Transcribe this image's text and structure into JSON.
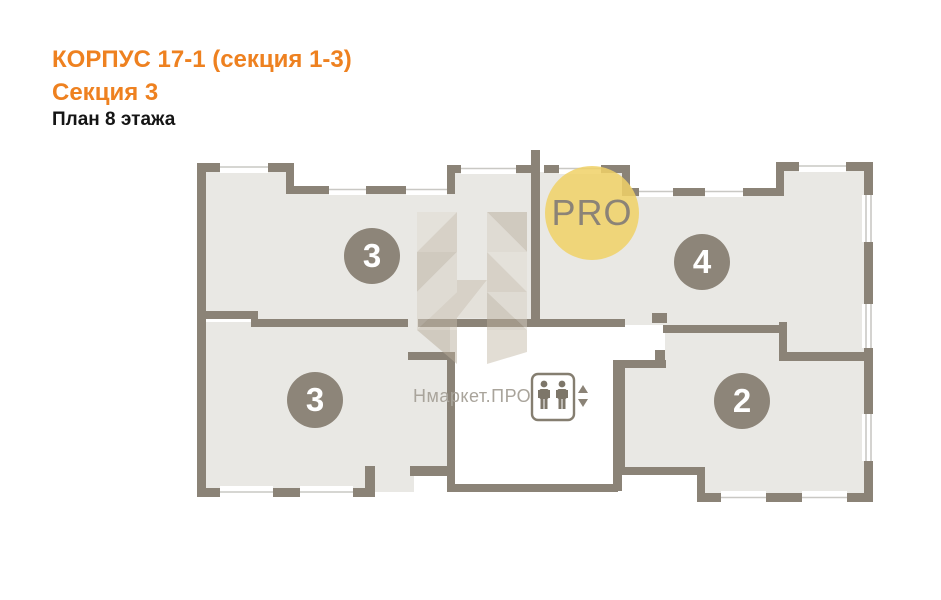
{
  "header": {
    "building_title": "КОРПУС 17-1 (секция 1-3)",
    "section_title": "Секция 3",
    "floor_title": "План 8 этажа"
  },
  "floorplan": {
    "apartments": [
      {
        "position": "top-left",
        "number": "3"
      },
      {
        "position": "top-right",
        "number": "4"
      },
      {
        "position": "bottom-left",
        "number": "3"
      },
      {
        "position": "bottom-right",
        "number": "2"
      }
    ],
    "elevator": {
      "type": "passenger-elevator",
      "figures": 2,
      "arrows": [
        "up",
        "down"
      ]
    }
  },
  "watermark": {
    "logo_text": "PRO",
    "brand_text": "Нмаркет.ПРО",
    "logo_letter": "Н"
  },
  "colors": {
    "accent_orange": "#ee8120",
    "wall": "#8b8377",
    "room_fill": "#e9e8e4",
    "number_badge": "#8d8579",
    "pro_circle_yellow": "#f0d166",
    "watermark_text": "#a9a49b",
    "window_line": "#c9c8c4"
  }
}
